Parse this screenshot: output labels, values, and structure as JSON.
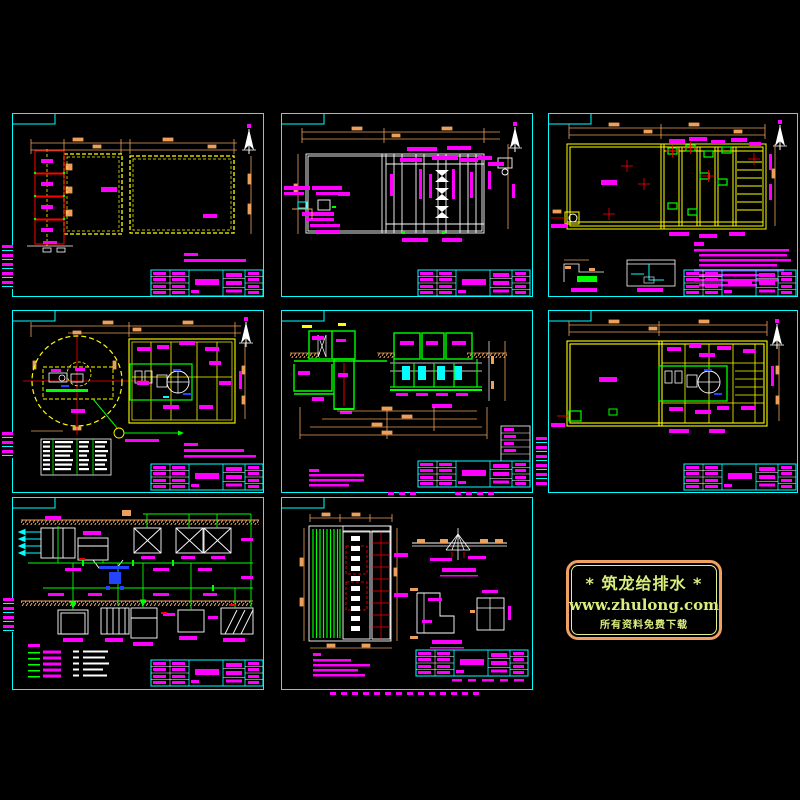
{
  "app": {
    "description": "CAD drawing set, 8 sheets of a wastewater treatment plant",
    "background": "#000000"
  },
  "watermark": {
    "line1": "* 筑龙给排水 *",
    "line2": "www.zhulong.com",
    "line3": "所有资料免费下载",
    "border_color": "#f0a061",
    "inner_border_color": "#e4ef8e",
    "text_color": "#d9ee7e"
  },
  "palette": {
    "frame_cyan": "#00ffff",
    "wall_yellow": "#ffff00",
    "dimension_orange": "#eda05c",
    "label_magenta": "#ff00ff",
    "pipe_green": "#00ff00",
    "line_white": "#ffffff",
    "mark_red": "#ff0000",
    "equipment_blue": "#2244ff"
  }
}
